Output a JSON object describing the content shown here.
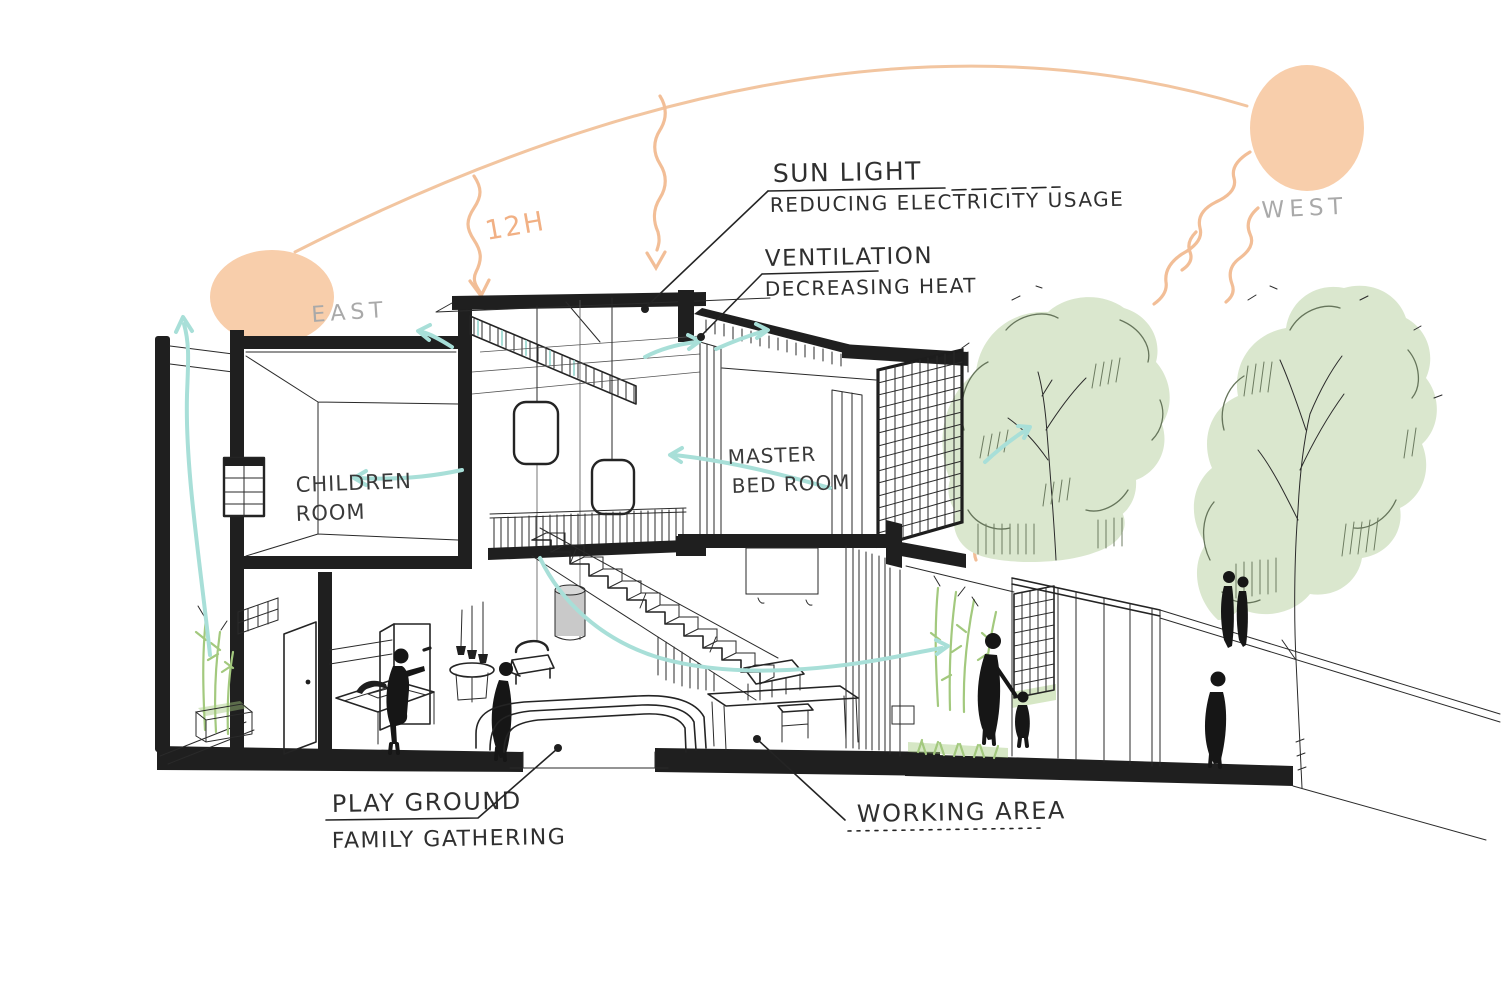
{
  "image_type": "hand-drawn architectural concept section sketch",
  "compass": {
    "east_label": "EAST",
    "west_label": "WEST"
  },
  "sun": {
    "hours_label": "12H"
  },
  "annotations": {
    "sun_light": {
      "title": "SUN LIGHT",
      "subtitle": "REDUCING ELECTRICITY USAGE"
    },
    "ventilation": {
      "title": "VENTILATION",
      "subtitle": "DECREASING HEAT"
    },
    "play_ground": {
      "title": "PLAY GROUND",
      "subtitle": "FAMILY GATHERING"
    },
    "working_area": {
      "title": "WORKING AREA"
    }
  },
  "rooms": {
    "children_room": {
      "line1": "CHILDREN",
      "line2": "ROOM"
    },
    "master_bedroom": {
      "line1": "MASTER",
      "line2": "BED ROOM"
    }
  },
  "colors": {
    "background": "#FFFFFF",
    "sun_fill": "#F8CEAB",
    "sun_path_arc": "#F2C5A0",
    "sun_ray": "#F2BE97",
    "hours_text": "#F1B084",
    "compass_text": "#A9A9A9",
    "air_flow": "#A8DFD8",
    "foliage_fill": "#DAE7CE",
    "foliage_stroke": "#66755B",
    "bamboo": "#A3C97E",
    "ink": "#242424"
  }
}
